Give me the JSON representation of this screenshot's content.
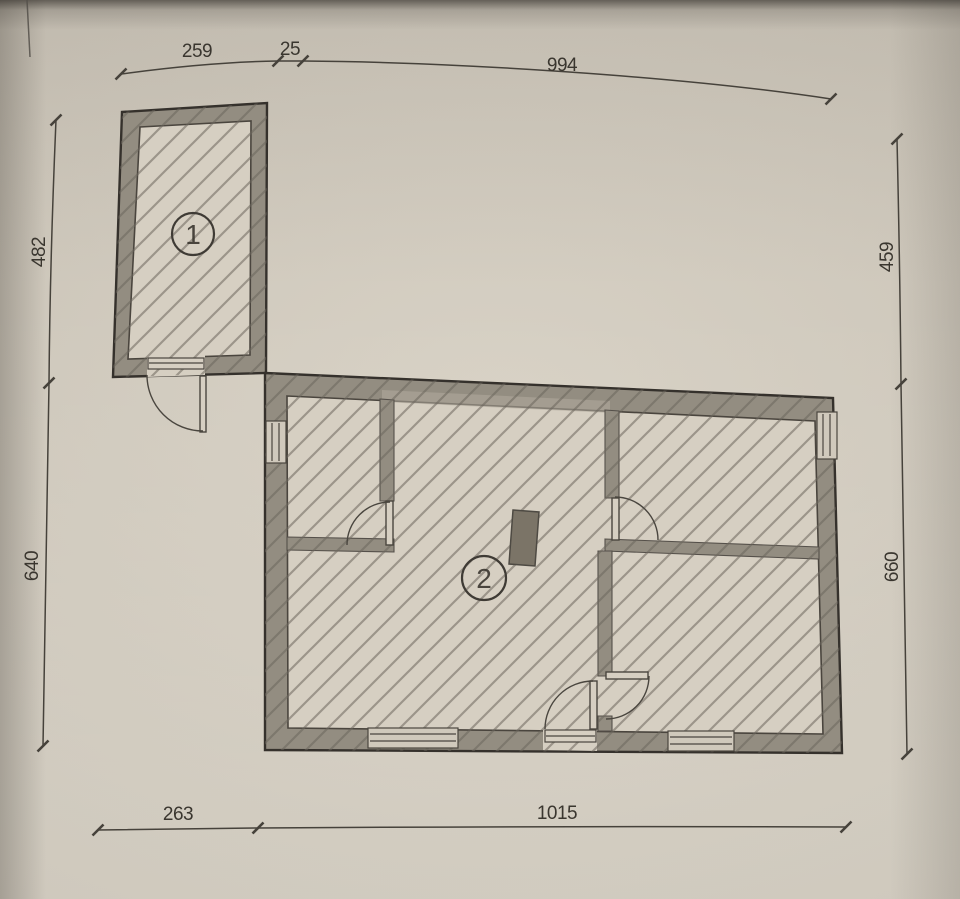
{
  "document": {
    "kind": "architectural floor plan (scanned page)",
    "rooms": [
      {
        "number": "1"
      },
      {
        "number": "2"
      }
    ],
    "dimensions": {
      "top": [
        "259",
        "25",
        "994"
      ],
      "left": [
        "482",
        "640"
      ],
      "right": [
        "459",
        "660"
      ],
      "bottom": [
        "263",
        "1015"
      ]
    },
    "colors": {
      "paper": "#d3ccbf",
      "ink": "#3f3b35",
      "wall": "#938d81",
      "floor": "#d6cfc2",
      "chimney": "#7b7467"
    }
  }
}
